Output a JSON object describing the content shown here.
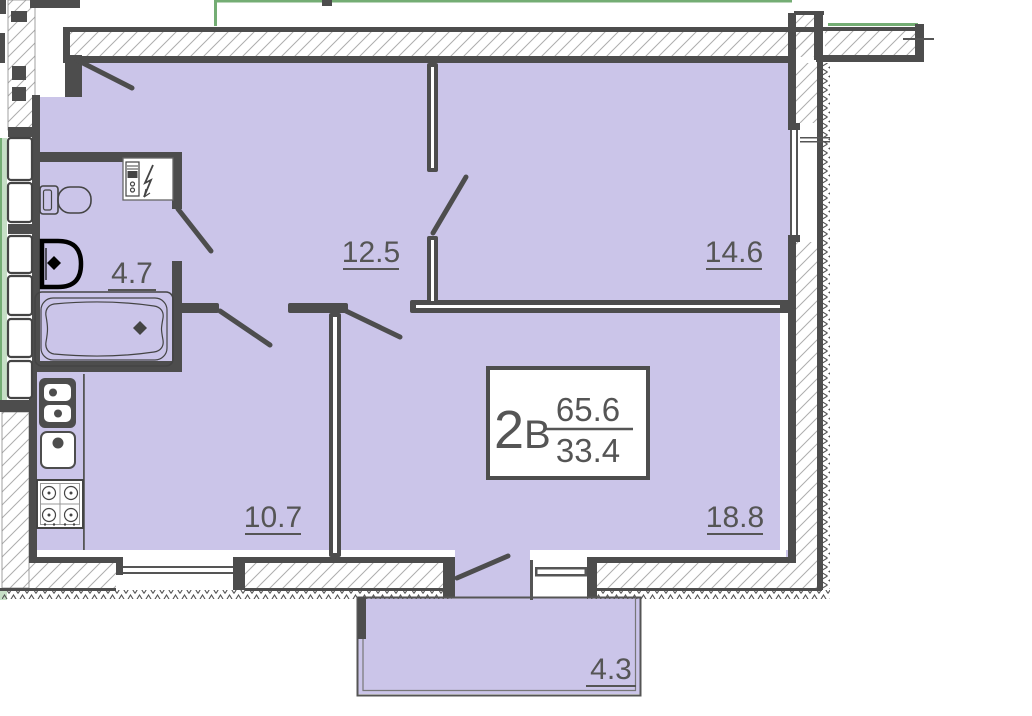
{
  "title": "Apartment floor plan",
  "unit": {
    "type_digit": "2",
    "type_letter": "В",
    "total_area": "65.6",
    "living_area": "33.4"
  },
  "rooms": [
    {
      "name": "bathroom",
      "area": "4.7"
    },
    {
      "name": "hallway",
      "area": "12.5"
    },
    {
      "name": "bedroom",
      "area": "14.6"
    },
    {
      "name": "kitchen",
      "area": "10.7"
    },
    {
      "name": "living-room",
      "area": "18.8"
    },
    {
      "name": "balcony",
      "area": "4.3"
    }
  ],
  "colors": {
    "room_fill": "#cbc5e9",
    "wall": "#4d4d4d",
    "line": "#555555",
    "text": "#555555",
    "neighbor_green": "#74ad74",
    "neighbor_green_fill": "#c6dfc6"
  }
}
